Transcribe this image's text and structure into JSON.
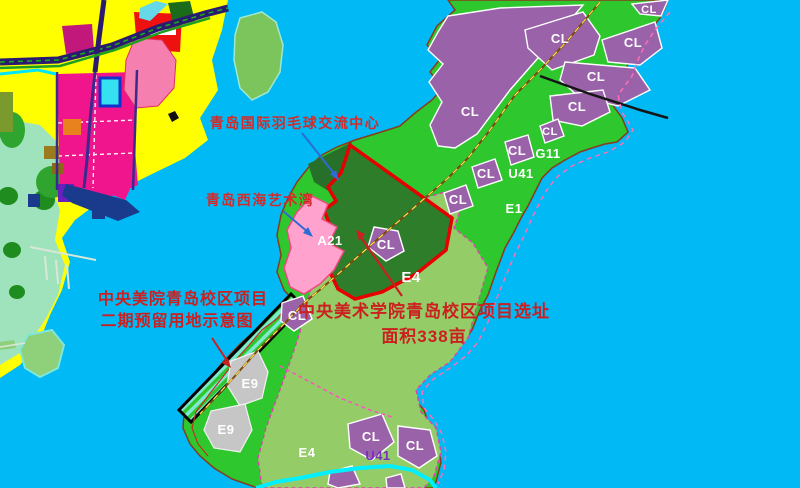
{
  "map": {
    "annotations": {
      "badminton_center": "青岛国际羽毛球交流中心",
      "art_bay": "青岛西海艺术湾",
      "phase2_line1": "中央美院青岛校区项目",
      "phase2_line2": "二期预留用地示意图",
      "site_line1": "中央美术学院青岛校区项目选址",
      "site_line2": "面积338亩"
    },
    "zone_codes": {
      "cl": "CL",
      "a21": "A21",
      "e1": "E1",
      "e4": "E4",
      "e9": "E9",
      "g11": "G11",
      "u41": "U41"
    },
    "colors": {
      "water": "#00B9F5",
      "parkland_green": "#2EC82E",
      "e4_light_green": "#94CD68",
      "cl_purple": "#9A62A8",
      "site_dark_green": "#2E7D2B",
      "site_outline_red": "#E60000",
      "a21_pink": "#FFA3CE",
      "e9_gray": "#C6C6C6",
      "annotation_red": "#D42A2A",
      "arrow_blue": "#2E6BD4",
      "mainland_yellow": "#FFFF00",
      "mainland_magenta": "#F0158C"
    }
  }
}
